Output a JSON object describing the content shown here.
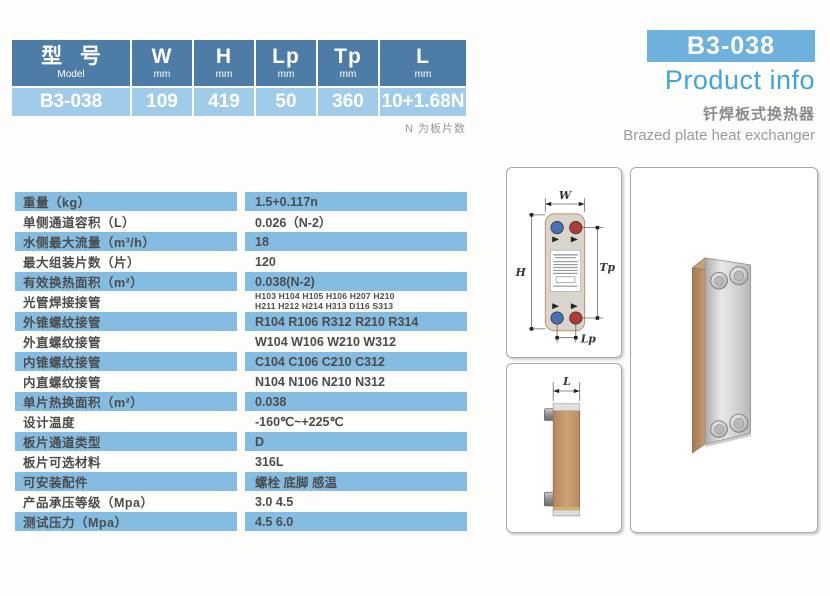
{
  "model_table": {
    "columns": [
      {
        "label": "型 号",
        "unit": "Model",
        "value": "B3-038"
      },
      {
        "label": "W",
        "unit": "mm",
        "value": "109"
      },
      {
        "label": "H",
        "unit": "mm",
        "value": "419"
      },
      {
        "label": "Lp",
        "unit": "mm",
        "value": "50"
      },
      {
        "label": "Tp",
        "unit": "mm",
        "value": "360"
      },
      {
        "label": "L",
        "unit": "mm",
        "value": "10+1.68N"
      }
    ],
    "note": "N 为板片数"
  },
  "product_header": {
    "model": "B3-038",
    "title": "Product info",
    "subtitle_cn": "钎焊板式换热器",
    "subtitle_en": "Brazed plate heat exchanger"
  },
  "spec_table": {
    "rows": [
      {
        "label": "重量（kg）",
        "value": "1.5+0.117n"
      },
      {
        "label": "单侧通道容积（L）",
        "value": "0.026（N-2）"
      },
      {
        "label": "水侧最大流量（m³/h）",
        "value": "18"
      },
      {
        "label": "最大组装片数（片）",
        "value": "120"
      },
      {
        "label": "有效换热面积（m²）",
        "value": "0.038(N-2)"
      },
      {
        "label": "光管焊接接管",
        "value": "H103 H104 H105 H106 H207 H210\nH211 H212 H214 H313 D116 S313"
      },
      {
        "label": "外锥螺纹接管",
        "value": "R104 R106 R312 R210 R314"
      },
      {
        "label": "外直螺纹接管",
        "value": "W104 W106 W210 W312"
      },
      {
        "label": "内锥螺纹接管",
        "value": "C104 C106 C210 C312"
      },
      {
        "label": "内直螺纹接管",
        "value": "N104 N106 N210 N312"
      },
      {
        "label": "单片热换面积（m²）",
        "value": "0.038"
      },
      {
        "label": "设计温度",
        "value": "-160℃~+225℃"
      },
      {
        "label": "板片通道类型",
        "value": "D"
      },
      {
        "label": "板片可选材料",
        "value": "316L"
      },
      {
        "label": "可安装配件",
        "value": "螺栓 底脚 感温"
      },
      {
        "label": "产品承压等级（Mpa）",
        "value": "3.0 4.5"
      },
      {
        "label": "测试压力（Mpa）",
        "value": "4.5 6.0"
      }
    ]
  },
  "diagram_labels": {
    "w": "W",
    "h": "H",
    "tp": "Tp",
    "lp": "Lp",
    "l": "L"
  },
  "colors": {
    "header_blue": "#4d7ca7",
    "header_value_blue": "#a1cce9",
    "spec_row_blue": "#85bde2",
    "badge_blue": "#6eb1dc",
    "title_blue": "#41a5d8",
    "port_blue": "#4a70b4",
    "port_red": "#b03a3a",
    "copper": "#c0966a"
  }
}
